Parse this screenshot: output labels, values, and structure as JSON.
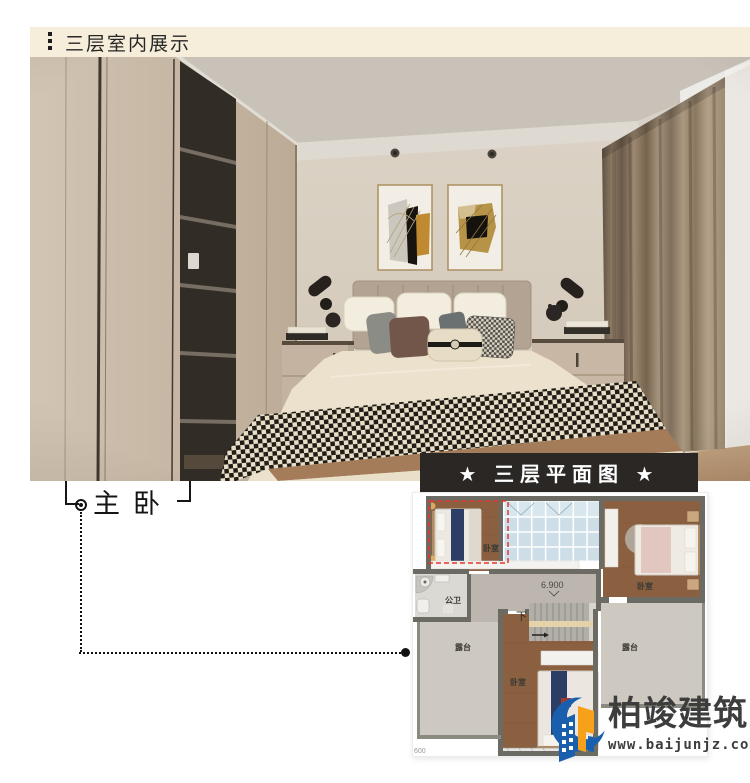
{
  "header": {
    "title": "三层室内展示",
    "bg_color": "#f6eedb",
    "text_color": "#262626"
  },
  "photo": {
    "description": "master bedroom interior render",
    "callout_label": "主卧"
  },
  "plan": {
    "title": "★ 三层平面图 ★",
    "titlebar_bg": "#2a2724",
    "highlight_color": "#e4372e",
    "elevation_label": "6.900",
    "stairs_down_label": "下",
    "partial_dimension": "600",
    "rooms": {
      "bedroom_top_left": "卧室",
      "bedroom_top_right": "卧室",
      "bedroom_bottom": "卧室",
      "bathroom": "公卫",
      "terrace_left": "露台",
      "terrace_right": "露台"
    }
  },
  "logo": {
    "name": "柏竣建筑",
    "website": "www.baijunjz.com",
    "blue": "#1a5fae",
    "orange": "#f7a11a",
    "text_color": "#3d3d3d"
  }
}
